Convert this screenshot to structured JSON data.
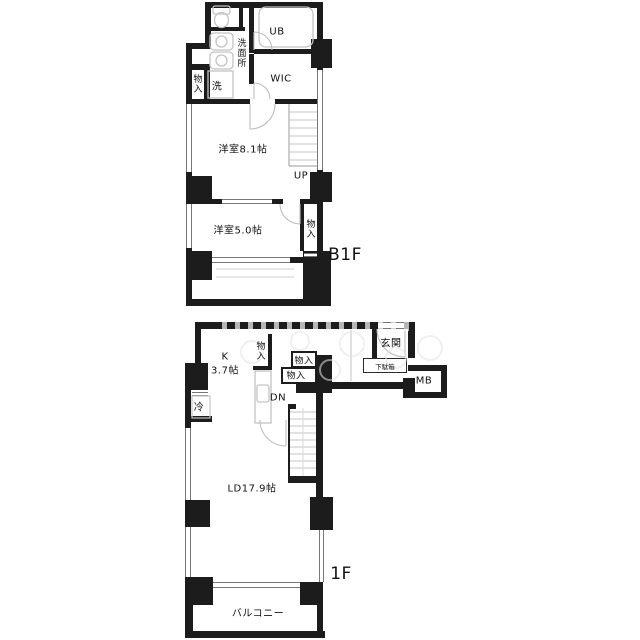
{
  "plan_title": "apartment-floor-plan",
  "b1f": {
    "floor_label": "B1F",
    "labels": {
      "ub": "UB",
      "washroom": "洗面所",
      "wic": "WIC",
      "closet_left": "物入",
      "washer": "洗",
      "bedroom_8_1": "洋室8.1帖",
      "stairs_up": "UP",
      "bedroom_5_0": "洋室5.0帖",
      "closet_right": "物入"
    }
  },
  "f1": {
    "floor_label": "1F",
    "labels": {
      "entrance": "玄関",
      "shoe_cabinet": "下駄箱",
      "meter_box": "MB",
      "kitchen_name": "K",
      "kitchen_size": "3.7帖",
      "closet_kitchen": "物入",
      "closet_hall_upper": "物入",
      "closet_hall_lower": "物入",
      "refrigerator": "冷",
      "stairs_down": "DN",
      "living_dining": "LD17.9帖",
      "balcony": "バルコニー"
    }
  },
  "colors": {
    "wall": "#1c1c1c",
    "fixture_line": "#c4c4c4",
    "window_line": "#777777",
    "text": "#111111",
    "background": "#ffffff"
  }
}
